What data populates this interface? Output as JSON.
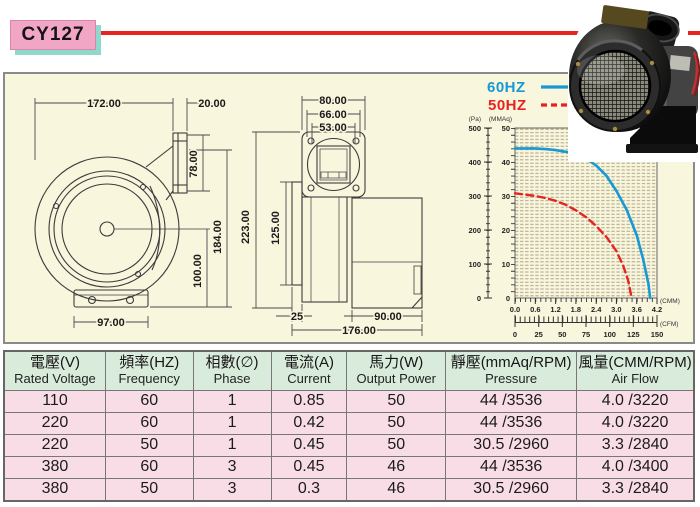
{
  "header": {
    "model": "CY127"
  },
  "colors": {
    "accent_red": "#e8231f",
    "badge_pink": "#f2a6c5",
    "badge_shadow_teal": "#8fd8cc",
    "panel_cream": "#f9f6de",
    "table_header_green": "#d9ecdb",
    "table_row_pink": "#f9dde6",
    "curve_blue": "#1899d3",
    "curve_red": "#e8231f"
  },
  "drawing": {
    "front": {
      "width_total": "172.00",
      "flange_width": "20.00",
      "outlet_height": "78.00",
      "height_outlet_to_base": "184.00",
      "height_center_to_base": "100.00",
      "base_width": "97.00"
    },
    "side": {
      "flange_width": "80.00",
      "bolt_spacing": "66.00",
      "opening_width": "53.00",
      "height_total": "223.00",
      "body_depth": "125.00",
      "plate_depth": "25",
      "motor_depth": "90.00",
      "depth_total": "176.00"
    }
  },
  "chart": {
    "pa_label": "(Pa)",
    "mmaq_label": "(MMAq)",
    "cmm_label": "(CMM)",
    "cfm_label": "(CFM)",
    "pa_ticks": [
      "500",
      "400",
      "300",
      "200",
      "100",
      "0"
    ],
    "mmaq_ticks": [
      "50",
      "40",
      "30",
      "20",
      "10",
      "0"
    ],
    "cmm_ticks": [
      "0.0",
      "0.6",
      "1.2",
      "1.8",
      "2.4",
      "3.0",
      "3.6",
      "4.2"
    ],
    "cfm_ticks": [
      "0",
      "25",
      "50",
      "75",
      "100",
      "125",
      "150"
    ]
  },
  "chart_data": {
    "type": "line",
    "title": "",
    "xlabel": "(CMM)",
    "x2label": "(CFM)",
    "ylabel_left": "(Pa)",
    "ylabel_right": "(MMAq)",
    "xlim": [
      0,
      4.2
    ],
    "ylim_left_pa": [
      0,
      500
    ],
    "ylim_right_mmaq": [
      0,
      50
    ],
    "grid": true,
    "legend_position": "top-left",
    "series": [
      {
        "name": "60HZ",
        "color": "#1899d3",
        "line_style": "solid",
        "x_unit": "CMM",
        "y_unit": "mmAq",
        "points": [
          [
            0,
            44
          ],
          [
            0.3,
            44
          ],
          [
            0.6,
            44
          ],
          [
            0.9,
            43.8
          ],
          [
            1.2,
            43.5
          ],
          [
            1.5,
            43
          ],
          [
            1.8,
            42.3
          ],
          [
            2.1,
            41
          ],
          [
            2.4,
            39
          ],
          [
            2.7,
            36
          ],
          [
            3.0,
            31.5
          ],
          [
            3.3,
            26
          ],
          [
            3.6,
            18.5
          ],
          [
            3.8,
            11
          ],
          [
            3.95,
            4
          ],
          [
            4.0,
            0
          ]
        ]
      },
      {
        "name": "50HZ",
        "color": "#e8231f",
        "line_style": "dashed",
        "x_unit": "CMM",
        "y_unit": "mmAq",
        "points": [
          [
            0,
            30.8
          ],
          [
            0.3,
            30.4
          ],
          [
            0.6,
            30
          ],
          [
            0.9,
            29.4
          ],
          [
            1.2,
            28.6
          ],
          [
            1.5,
            27.4
          ],
          [
            1.8,
            25.8
          ],
          [
            2.1,
            23.8
          ],
          [
            2.4,
            21.2
          ],
          [
            2.7,
            18
          ],
          [
            3.0,
            13.8
          ],
          [
            3.2,
            9.5
          ],
          [
            3.35,
            5
          ],
          [
            3.45,
            0
          ]
        ]
      }
    ]
  },
  "table": {
    "headers": [
      {
        "zh": "電壓(V)",
        "en": "Rated Voltage"
      },
      {
        "zh": "頻率(HZ)",
        "en": "Frequency"
      },
      {
        "zh": "相數(∅)",
        "en": "Phase"
      },
      {
        "zh": "電流(A)",
        "en": "Current"
      },
      {
        "zh": "馬力(W)",
        "en": "Output Power"
      },
      {
        "zh": "靜壓(mmAq/RPM)",
        "en": "Pressure"
      },
      {
        "zh": "風量(CMM/RPM)",
        "en": "Air Flow"
      }
    ],
    "rows": [
      [
        "110",
        "60",
        "1",
        "0.85",
        "50",
        "44 /3536",
        "4.0 /3220"
      ],
      [
        "220",
        "60",
        "1",
        "0.42",
        "50",
        "44 /3536",
        "4.0 /3220"
      ],
      [
        "220",
        "50",
        "1",
        "0.45",
        "50",
        "30.5 /2960",
        "3.3 /2840"
      ],
      [
        "380",
        "60",
        "3",
        "0.45",
        "46",
        "44 /3536",
        "4.0 /3400"
      ],
      [
        "380",
        "50",
        "3",
        "0.3",
        "46",
        "30.5 /2960",
        "3.3 /2840"
      ]
    ]
  }
}
